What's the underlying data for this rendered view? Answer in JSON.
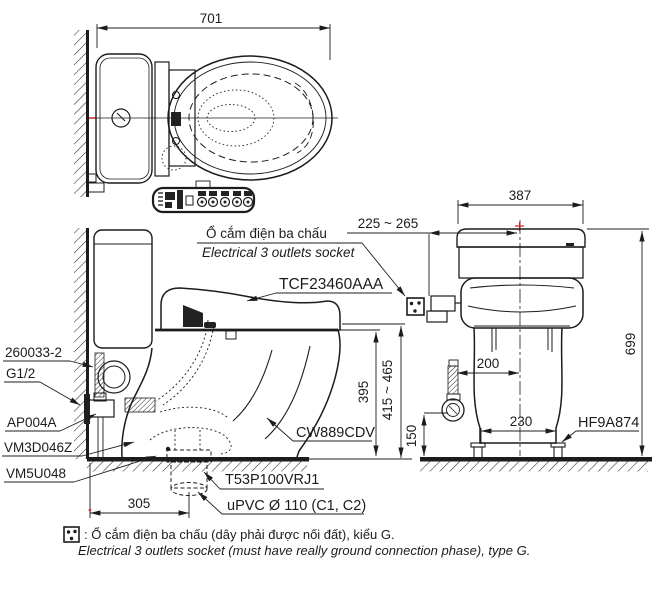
{
  "views": {
    "top": {
      "dim_total_depth": "701"
    },
    "side": {
      "dim_drain_offset": "305",
      "dim_bowl_height": "395",
      "dim_seat_height_range": "415 ~ 465",
      "label_socket_vi": "Ổ cắm điện ba chấu",
      "label_socket_en": "Electrical 3 outlets socket",
      "label_washlet_model": "TCF23460AAA",
      "label_bowl_model": "CW889CDV",
      "label_supply_hose": "260033-2",
      "label_thread_size": "G1/2",
      "label_stop_valve": "AP004A",
      "label_connector": "VM3D046Z",
      "label_flange_seal": "VM5U048",
      "label_drain_socket": "T53P100VRJ1",
      "label_drain_pipe": "uPVC Ø 110 (C1, C2)"
    },
    "front": {
      "dim_tank_width": "387",
      "dim_total_height": "699",
      "dim_socket_range": "225 ~ 265",
      "dim_supply_offset": "200",
      "dim_bolt_spacing": "230",
      "dim_valve_height": "150",
      "label_bolt_cap": "HF9A874"
    }
  },
  "footnote": {
    "vi": ": Ổ cắm điện ba chấu (dây phải được nối đất), kiểu G.",
    "en": "Electrical 3 outlets socket (must have really ground connection phase), type G."
  },
  "colors": {
    "line": "#1c1c1c",
    "accent_red": "#c8281e",
    "background": "#ffffff"
  }
}
